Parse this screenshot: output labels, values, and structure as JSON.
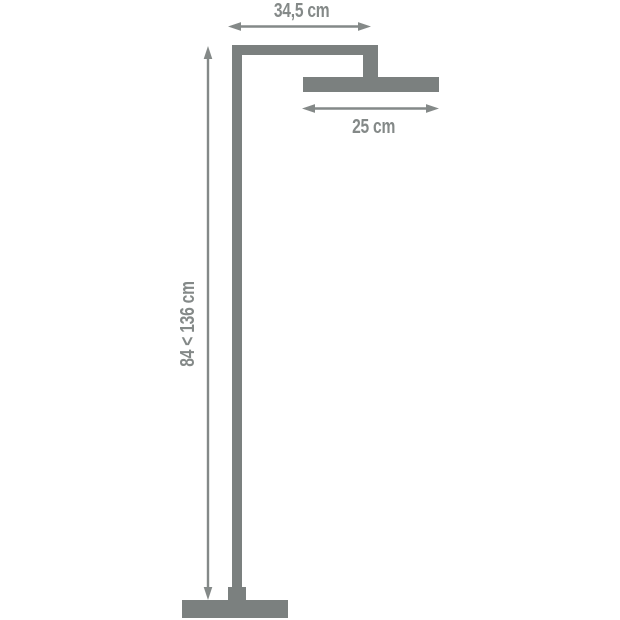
{
  "diagram": {
    "subject": "floor-standing shower column with overhead rain shower head and base plate",
    "colors": {
      "background": "#ffffff",
      "fixture": "#7b807f",
      "dimension": "#848988"
    },
    "dimensions": [
      {
        "id": "arm-width",
        "label": "34,5 cm",
        "orientation": "horizontal"
      },
      {
        "id": "head-width",
        "label": "25 cm",
        "orientation": "horizontal"
      },
      {
        "id": "pole-height",
        "label": "84 < 136 cm",
        "orientation": "vertical"
      }
    ]
  }
}
